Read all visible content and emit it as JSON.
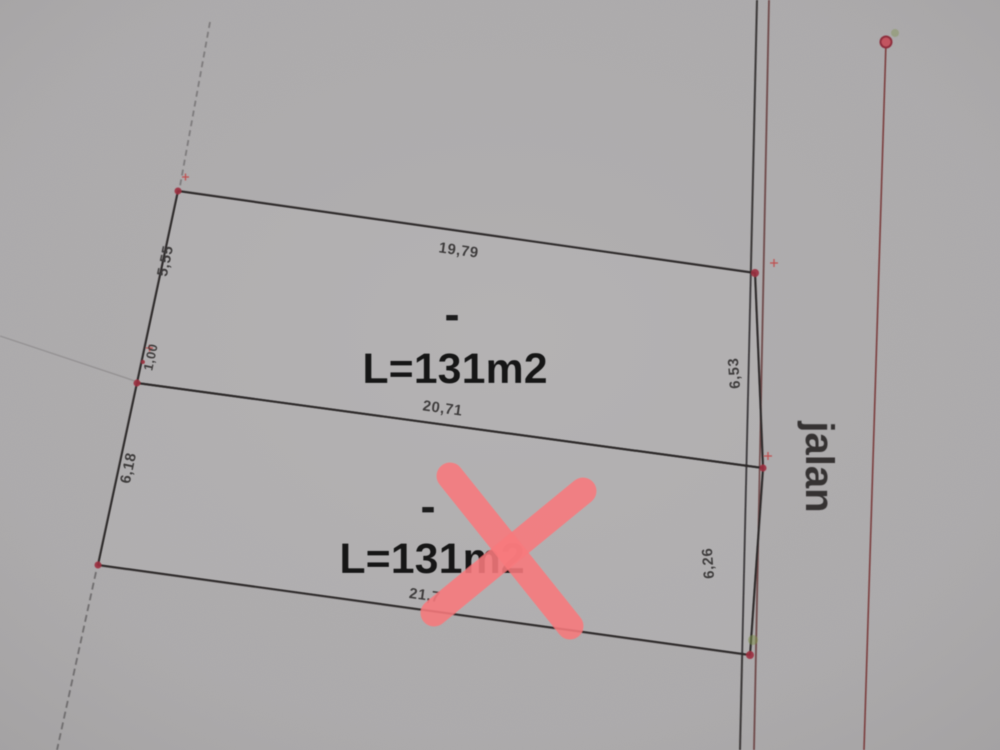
{
  "scene": {
    "background_color": "#acaaab",
    "line_color": "#2d2a2b",
    "cross_color": "#f8797c",
    "marker_color": "#a03040",
    "road_label": "jalan",
    "road_label_color": "#a8392c"
  },
  "plot1": {
    "dash": "-",
    "area_label": "L=131m2",
    "dim_top": "19,79",
    "dim_left_upper": "5,55",
    "dim_left_lower": "1,00",
    "dim_right": "6,53"
  },
  "shared_dim": "20,71",
  "plot2": {
    "dash": "-",
    "area_label": "L=131m2",
    "dim_left": "6,18",
    "dim_right": "6,26",
    "dim_bottom": "21,7",
    "crossed_out": true
  }
}
